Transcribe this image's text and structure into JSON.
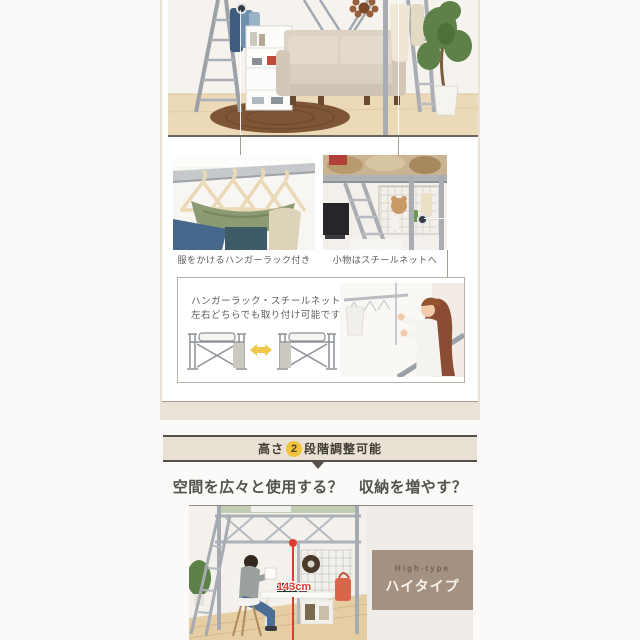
{
  "features": {
    "caption_hanger": "服をかけるハンガーラック付き",
    "caption_net": "小物はスチールネットへ",
    "note_line1": "ハンガーラック・スチールネットは",
    "note_line2": "左右どちらでも取り付け可能です。"
  },
  "height_section": {
    "banner_prefix": "高さ",
    "banner_number": "2",
    "banner_suffix": "段階調整可能",
    "heading": "空間を広々と使用する？　収納を増やす？",
    "type_en": "High-type",
    "type_ja": "ハイタイプ",
    "measurement": "143cm"
  },
  "colors": {
    "accent_yellow": "#f1c33d",
    "banner_band": "#e8e1d4",
    "banner_border": "#55514a",
    "section_beige": "#e9e2d6",
    "label_brown": "#a49181",
    "measure_red": "#e23a2e"
  }
}
